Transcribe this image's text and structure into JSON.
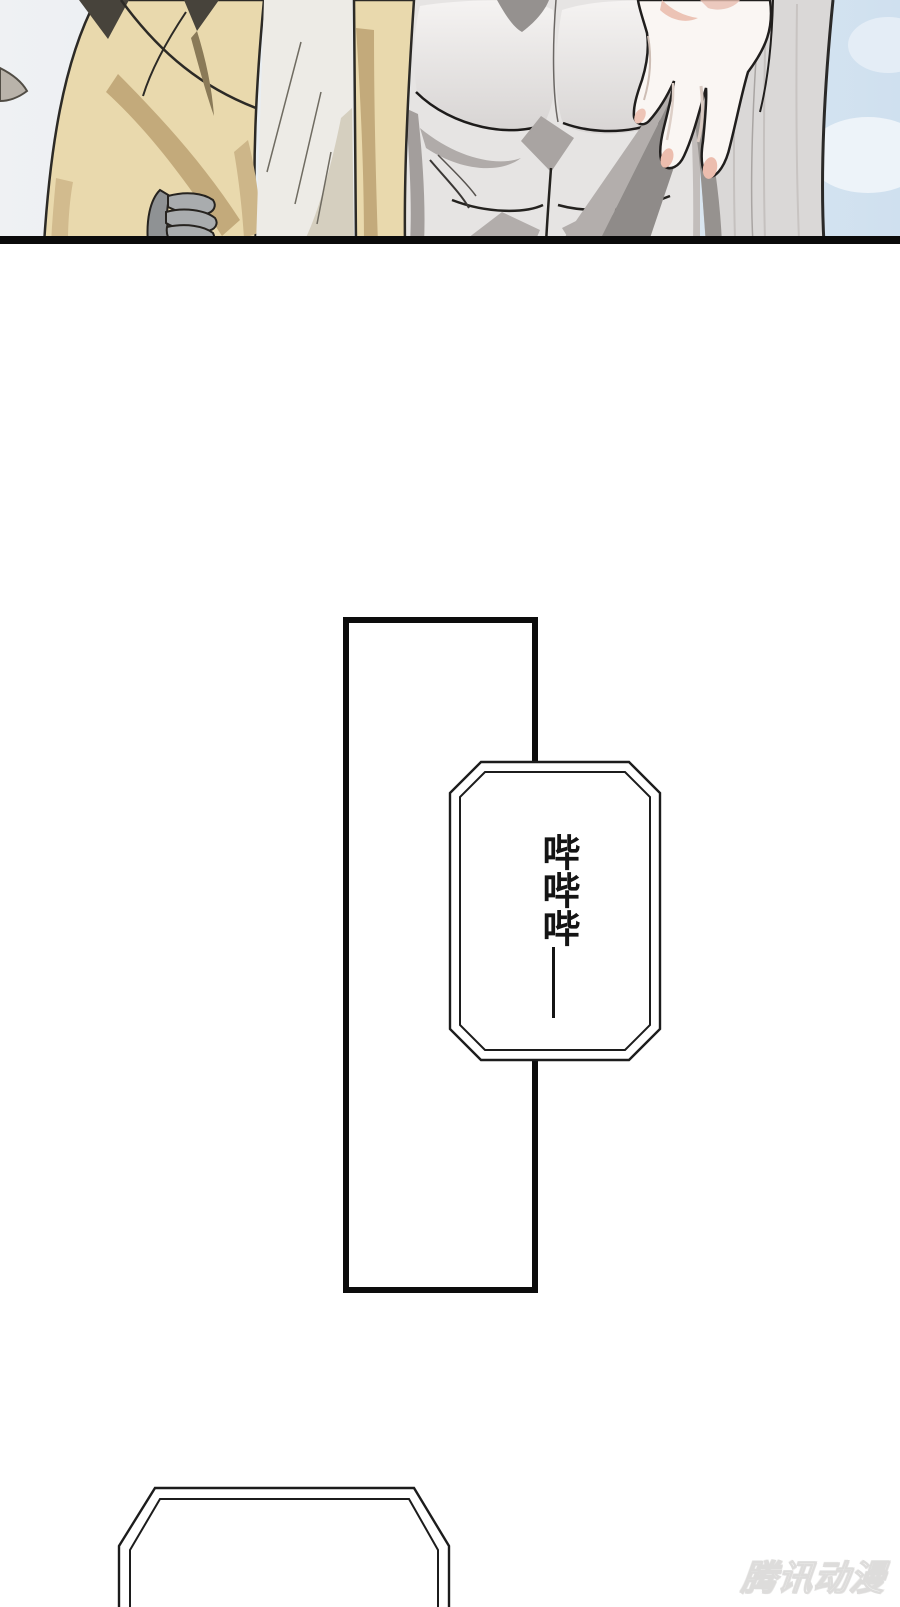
{
  "panel": {
    "colors": {
      "sky_left": "#eff1f3",
      "sky_right": "#cfe0ef",
      "shirt_tan": "#e9d9ad",
      "shirt_tan_shadow": "#c3aa7b",
      "robe_white": "#edebe6",
      "robe_shadow": "#d5cfbf",
      "torso_gray": "#e6e4e3",
      "torso_highlight": "#f5f3f2",
      "torso_shadow": "#aaa5a3",
      "hand_skin": "#faf6f3",
      "fingertip_pink": "#ecbdae",
      "fabric_gray": "#dad8d7",
      "glove_gray": "#a9acae",
      "panel_line_black": "#0a0a0a"
    }
  },
  "bubbles": {
    "beep": {
      "text": "哔哔哔——",
      "chars": "哔哔哔",
      "dash": "——"
    },
    "bottom": {
      "text": ""
    }
  },
  "watermark": {
    "text": "腾讯动漫",
    "color": "#dddcdb"
  }
}
